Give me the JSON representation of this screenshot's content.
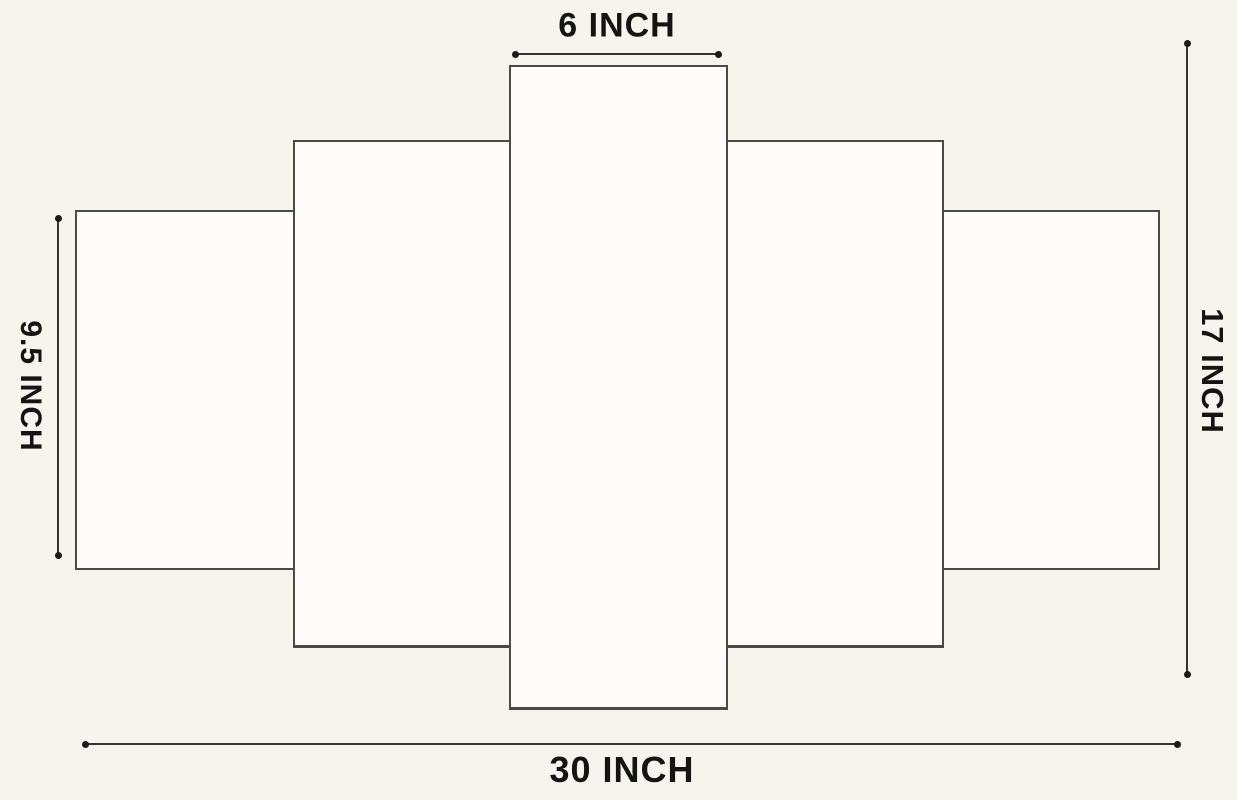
{
  "diagram": {
    "kind": "5-panel wall art dimension diagram",
    "labels": {
      "top": "6 INCH",
      "left": "9.5 INCH",
      "right": "17 INCH",
      "bottom": "30 INCH"
    },
    "measurements": {
      "center_panel_width_inch": 6,
      "outer_panel_height_inch": 9.5,
      "total_height_inch": 17,
      "total_width_inch": 30
    },
    "panel_count": 5,
    "colors": {
      "background": "#f7f4ee",
      "panel_fill": "#fdfcf8",
      "panel_border": "#4d4a45",
      "dimension_line": "#35332f",
      "text": "#161412"
    }
  }
}
